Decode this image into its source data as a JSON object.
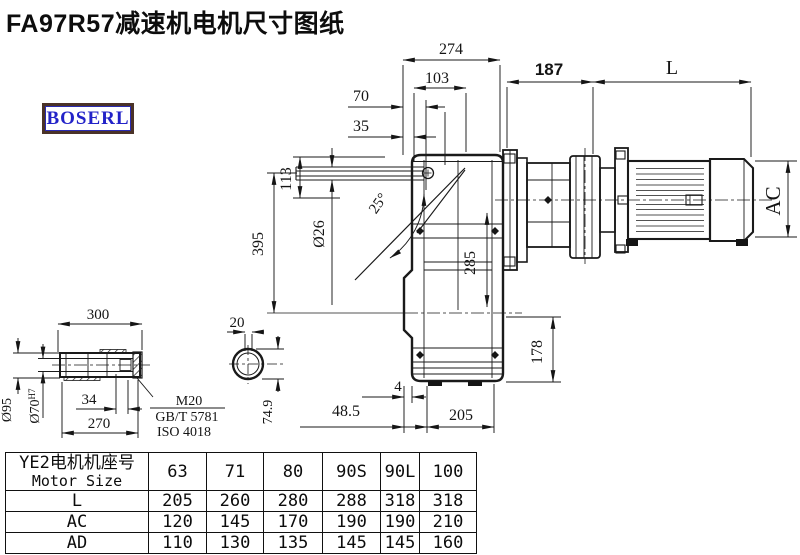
{
  "title": "FA97R57减速机电机尺寸图纸",
  "logo": {
    "text": "BOSERL"
  },
  "drawing": {
    "dims": {
      "d274": "274",
      "d103": "103",
      "d70": "70",
      "d35": "35",
      "d187": "187",
      "dL": "L",
      "dAC": "AC",
      "d395": "395",
      "d113": "113",
      "d26": "Ø26",
      "d25": "25°",
      "d285": "285",
      "d178": "178",
      "d4": "4",
      "d485": "48.5",
      "d205": "205",
      "d300": "300",
      "d270": "270",
      "d34": "34",
      "d95": "Ø95",
      "d70b": "Ø70",
      "d70sup": "H7",
      "d20": "20",
      "d749": "74.9",
      "m20": "M20",
      "gb": "GB/T 5781",
      "iso": "ISO 4018"
    }
  },
  "table": {
    "header_line1": "YE2电机机座号",
    "header_line2": "Motor Size",
    "columns": [
      "63",
      "71",
      "80",
      "90S",
      "90L",
      "100"
    ],
    "rows": [
      {
        "label": "L",
        "values": [
          "205",
          "260",
          "280",
          "288",
          "318",
          "318"
        ]
      },
      {
        "label": "AC",
        "values": [
          "120",
          "145",
          "170",
          "190",
          "190",
          "210"
        ]
      },
      {
        "label": "AD",
        "values": [
          "110",
          "130",
          "135",
          "145",
          "145",
          "160"
        ]
      }
    ]
  }
}
